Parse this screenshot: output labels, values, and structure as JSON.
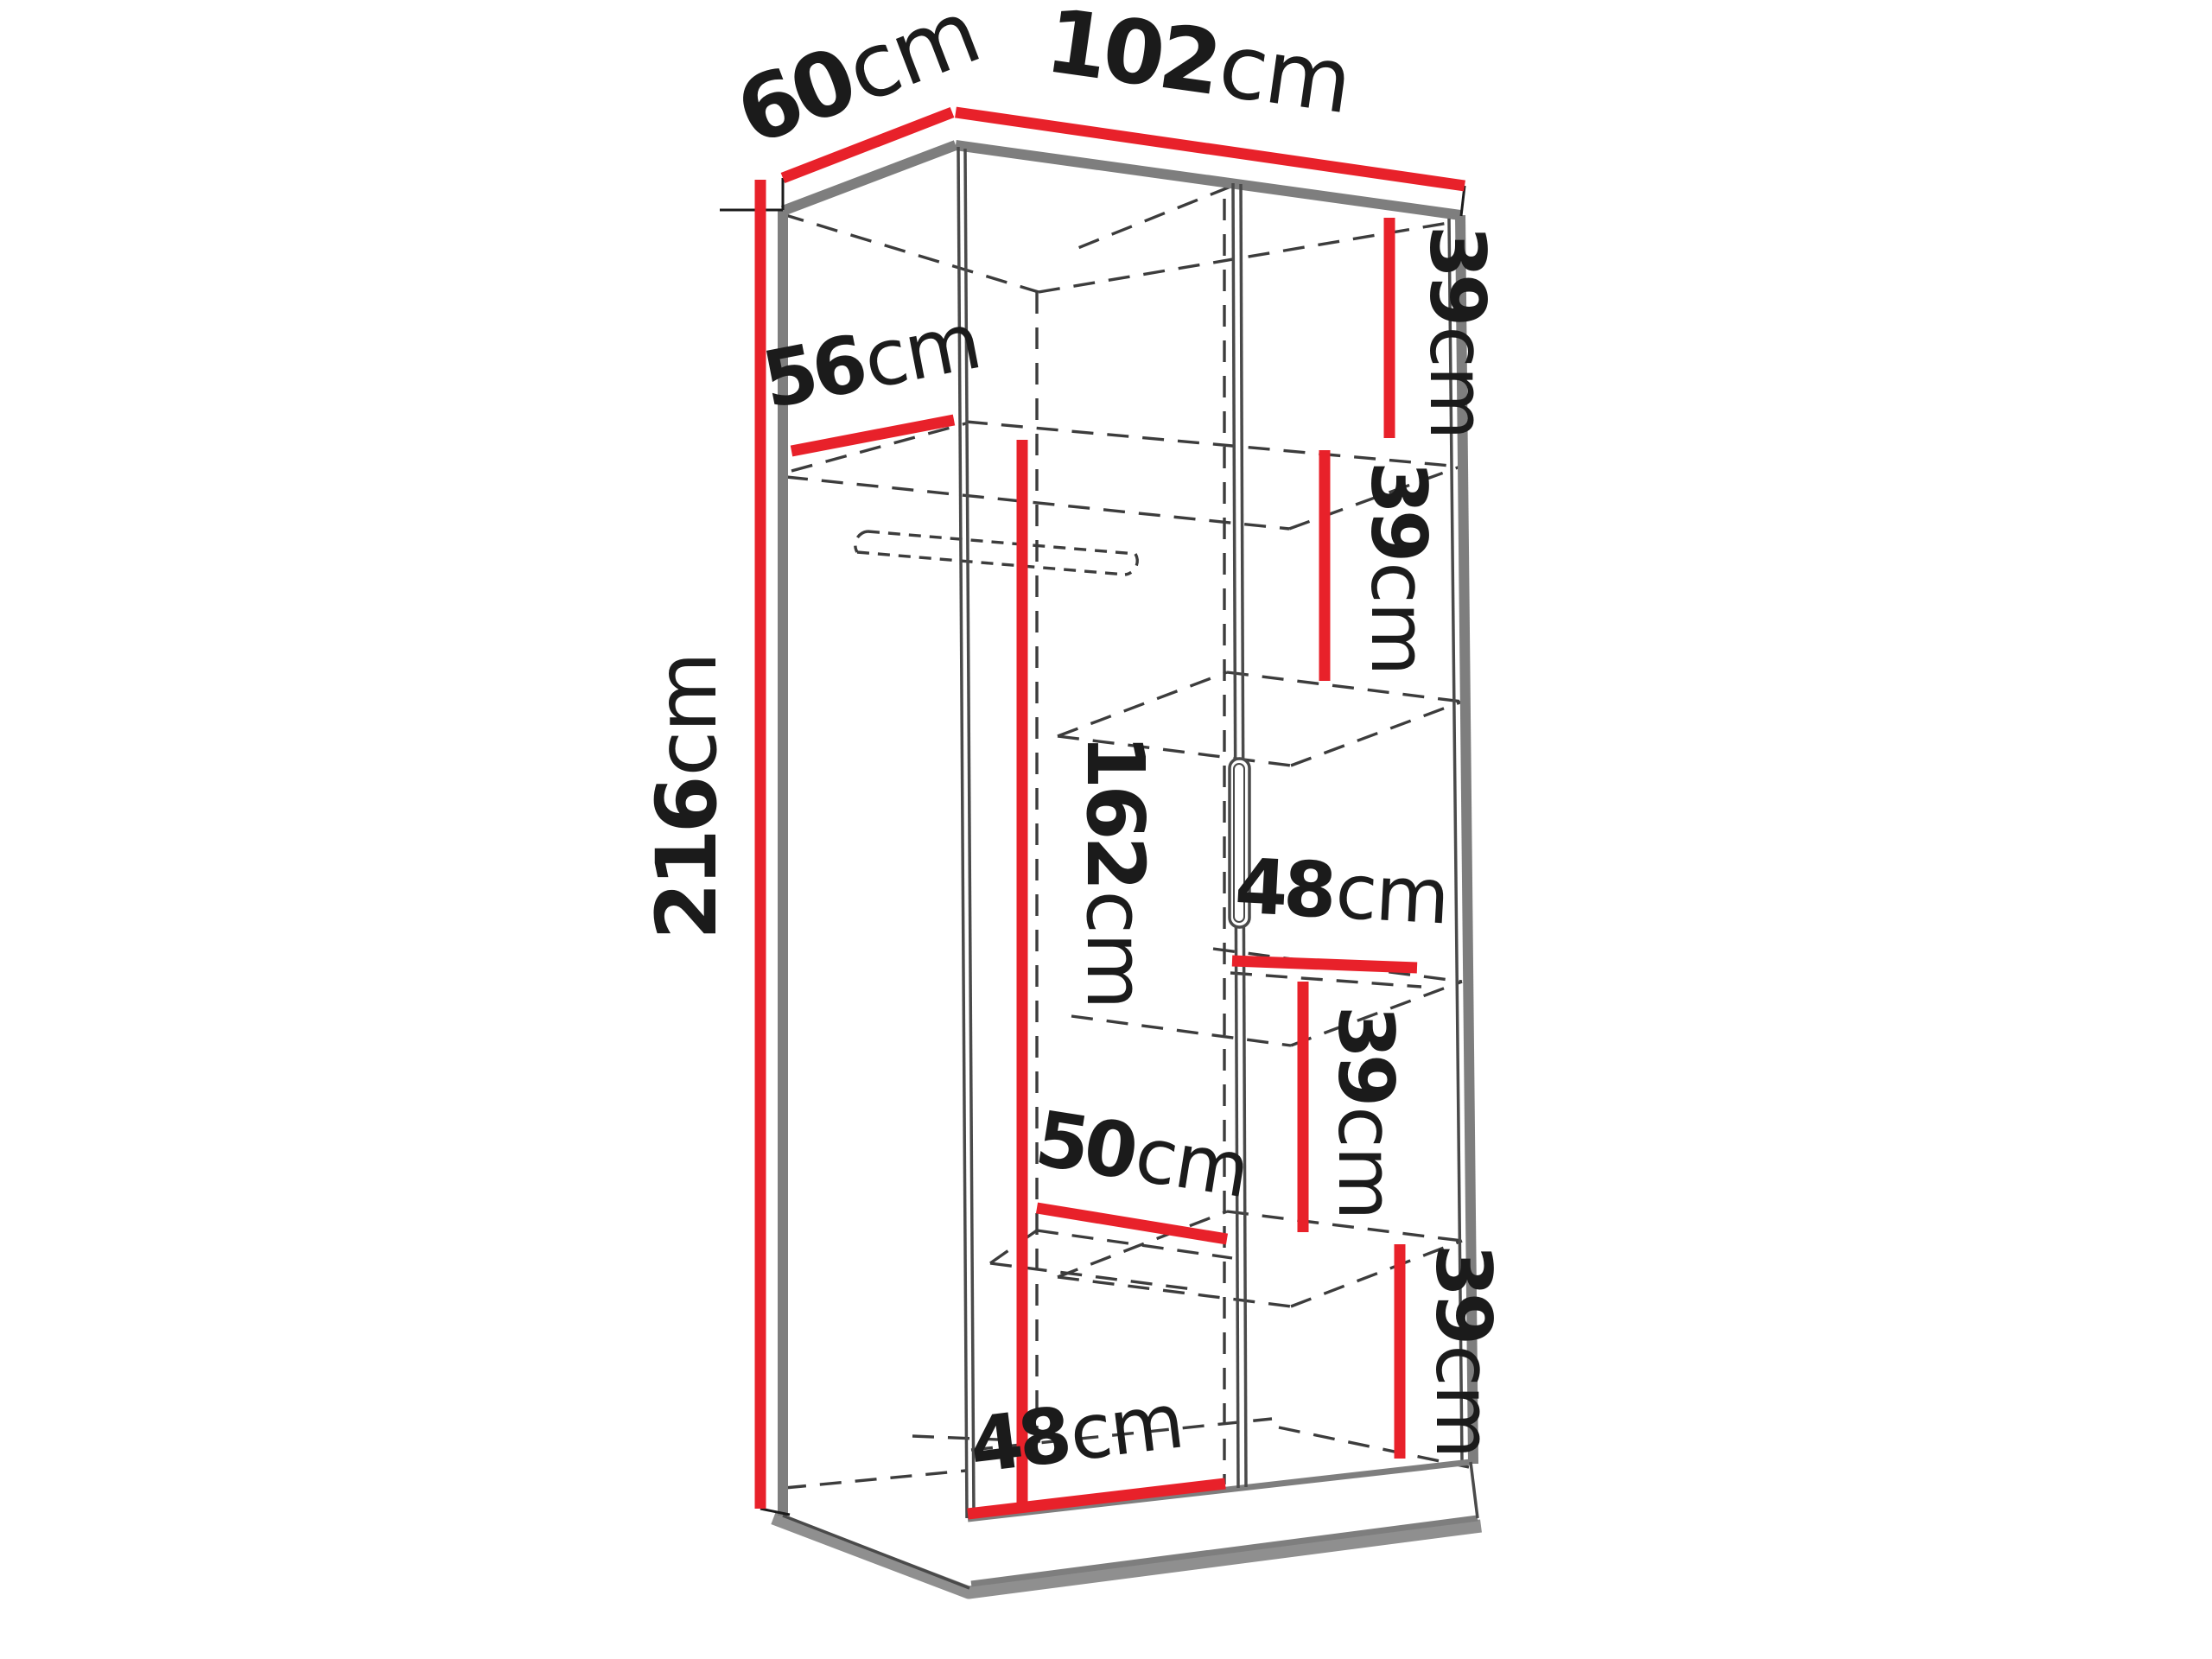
{
  "figure": {
    "type": "furniture-dimension-diagram",
    "subject": "two-door wardrobe with interior shelves and hanging rail, closed doors shown x-ray with dashed hidden lines",
    "background_color": "#ffffff",
    "dimension_line_color": "#e8212a",
    "edge_color": "#7e7e7e",
    "hidden_line_color": "#3c3c3c",
    "label_color": "#1b1b1b"
  },
  "measurements": {
    "top_width": {
      "value": "102",
      "unit": "cm"
    },
    "top_depth": {
      "value": "60",
      "unit": "cm"
    },
    "height": {
      "value": "216",
      "unit": "cm"
    },
    "interior_depth": {
      "value": "56",
      "unit": "cm"
    },
    "hanging_height": {
      "value": "162",
      "unit": "cm"
    },
    "right_gap_1": {
      "value": "39",
      "unit": "cm"
    },
    "right_gap_2": {
      "value": "39",
      "unit": "cm"
    },
    "right_section_width": {
      "value": "48",
      "unit": "cm"
    },
    "right_gap_3": {
      "value": "39",
      "unit": "cm"
    },
    "left_section_width": {
      "value": "50",
      "unit": "cm"
    },
    "right_gap_4": {
      "value": "39",
      "unit": "cm"
    },
    "left_bottom_width": {
      "value": "48",
      "unit": "cm"
    }
  }
}
